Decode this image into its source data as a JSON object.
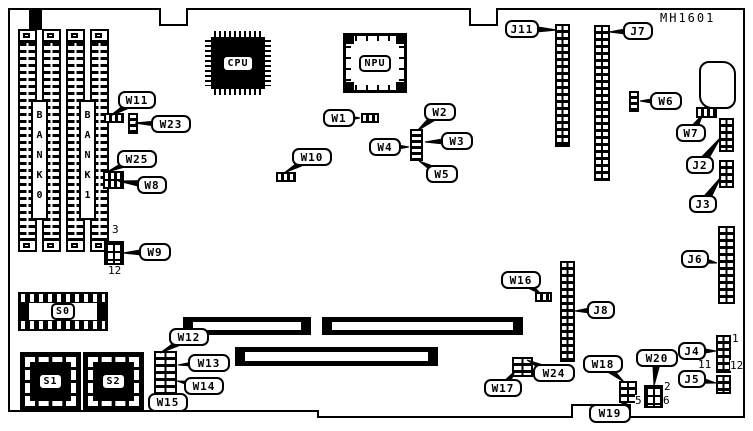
{
  "title": {
    "text": "MH1601"
  },
  "colors": {
    "ink": "#000000",
    "paper": "#ffffff"
  },
  "chips": {
    "cpu": "CPU",
    "npu": "NPU",
    "s0": "S0",
    "s1": "S1",
    "s2": "S2",
    "bank0": "BANK0",
    "bank1": "BANK1"
  },
  "callouts": [
    {
      "id": "j11",
      "label": "J11",
      "x": 505,
      "y": 20,
      "w": 34,
      "h": 18,
      "tx": 557,
      "ty": 30
    },
    {
      "id": "j7",
      "label": "J7",
      "x": 623,
      "y": 22,
      "w": 30,
      "h": 18,
      "tx": 609,
      "ty": 32
    },
    {
      "id": "w11",
      "label": "W11",
      "x": 118,
      "y": 91,
      "w": 38,
      "h": 18,
      "tx": 110,
      "ty": 116
    },
    {
      "id": "w23",
      "label": "W23",
      "x": 151,
      "y": 115,
      "w": 40,
      "h": 18,
      "tx": 135,
      "ty": 123
    },
    {
      "id": "w6",
      "label": "W6",
      "x": 650,
      "y": 92,
      "w": 32,
      "h": 18,
      "tx": 640,
      "ty": 101
    },
    {
      "id": "w1",
      "label": "W1",
      "x": 323,
      "y": 109,
      "w": 32,
      "h": 18,
      "tx": 360,
      "ty": 118
    },
    {
      "id": "w2",
      "label": "W2",
      "x": 424,
      "y": 103,
      "w": 32,
      "h": 18,
      "tx": 417,
      "ty": 131
    },
    {
      "id": "w4",
      "label": "W4",
      "x": 369,
      "y": 138,
      "w": 32,
      "h": 18,
      "tx": 409,
      "ty": 147
    },
    {
      "id": "w3",
      "label": "W3",
      "x": 441,
      "y": 132,
      "w": 32,
      "h": 18,
      "tx": 425,
      "ty": 142
    },
    {
      "id": "w5",
      "label": "W5",
      "x": 426,
      "y": 165,
      "w": 32,
      "h": 18,
      "tx": 419,
      "ty": 161
    },
    {
      "id": "w10",
      "label": "W10",
      "x": 292,
      "y": 148,
      "w": 40,
      "h": 18,
      "tx": 284,
      "ty": 173
    },
    {
      "id": "w7",
      "label": "W7",
      "x": 676,
      "y": 124,
      "w": 30,
      "h": 18,
      "tx": 703,
      "ty": 114
    },
    {
      "id": "w25",
      "label": "W25",
      "x": 117,
      "y": 150,
      "w": 40,
      "h": 18,
      "tx": 107,
      "ty": 172
    },
    {
      "id": "w8",
      "label": "W8",
      "x": 137,
      "y": 176,
      "w": 30,
      "h": 18,
      "tx": 118,
      "ty": 181
    },
    {
      "id": "j2",
      "label": "J2",
      "x": 686,
      "y": 156,
      "w": 28,
      "h": 18,
      "tx": 721,
      "ty": 137
    },
    {
      "id": "j3",
      "label": "J3",
      "x": 689,
      "y": 195,
      "w": 28,
      "h": 18,
      "tx": 721,
      "ty": 177
    },
    {
      "id": "w9",
      "label": "W9",
      "x": 139,
      "y": 243,
      "w": 32,
      "h": 18,
      "tx": 123,
      "ty": 253
    },
    {
      "id": "j6",
      "label": "J6",
      "x": 681,
      "y": 250,
      "w": 28,
      "h": 18,
      "tx": 717,
      "ty": 263
    },
    {
      "id": "w16",
      "label": "W16",
      "x": 501,
      "y": 271,
      "w": 40,
      "h": 18,
      "tx": 541,
      "ty": 294
    },
    {
      "id": "j8",
      "label": "J8",
      "x": 587,
      "y": 301,
      "w": 28,
      "h": 18,
      "tx": 575,
      "ty": 311
    },
    {
      "id": "w12",
      "label": "W12",
      "x": 169,
      "y": 328,
      "w": 40,
      "h": 18,
      "tx": 160,
      "ty": 353
    },
    {
      "id": "w13",
      "label": "W13",
      "x": 188,
      "y": 354,
      "w": 42,
      "h": 18,
      "tx": 178,
      "ty": 365
    },
    {
      "id": "w14",
      "label": "W14",
      "x": 184,
      "y": 377,
      "w": 40,
      "h": 18,
      "tx": 177,
      "ty": 381
    },
    {
      "id": "w15",
      "label": "W15",
      "x": 148,
      "y": 393,
      "w": 40,
      "h": 19,
      "tx": 163,
      "ty": 396
    },
    {
      "id": "w17",
      "label": "W17",
      "x": 484,
      "y": 379,
      "w": 38,
      "h": 18,
      "tx": 515,
      "ty": 371
    },
    {
      "id": "w24",
      "label": "W24",
      "x": 533,
      "y": 364,
      "w": 42,
      "h": 18,
      "tx": 527,
      "ty": 360
    },
    {
      "id": "w18",
      "label": "W18",
      "x": 583,
      "y": 355,
      "w": 40,
      "h": 18,
      "tx": 624,
      "ty": 382
    },
    {
      "id": "w19",
      "label": "W19",
      "x": 589,
      "y": 404,
      "w": 42,
      "h": 19,
      "tx": 629,
      "ty": 401
    },
    {
      "id": "w20",
      "label": "W20",
      "x": 636,
      "y": 349,
      "w": 42,
      "h": 18,
      "tx": 654,
      "ty": 386
    },
    {
      "id": "j4",
      "label": "J4",
      "x": 678,
      "y": 342,
      "w": 28,
      "h": 18,
      "tx": 716,
      "ty": 351
    },
    {
      "id": "j5",
      "label": "J5",
      "x": 678,
      "y": 370,
      "w": 28,
      "h": 18,
      "tx": 716,
      "ty": 383
    }
  ],
  "pin_numbers": [
    {
      "text": "3",
      "x": 112,
      "y": 224
    },
    {
      "text": "12",
      "x": 108,
      "y": 265
    },
    {
      "text": "1",
      "x": 732,
      "y": 333
    },
    {
      "text": "11",
      "x": 698,
      "y": 359
    },
    {
      "text": "12",
      "x": 730,
      "y": 360
    },
    {
      "text": "2",
      "x": 664,
      "y": 381
    },
    {
      "text": "5",
      "x": 635,
      "y": 395
    },
    {
      "text": "6",
      "x": 663,
      "y": 395
    }
  ]
}
